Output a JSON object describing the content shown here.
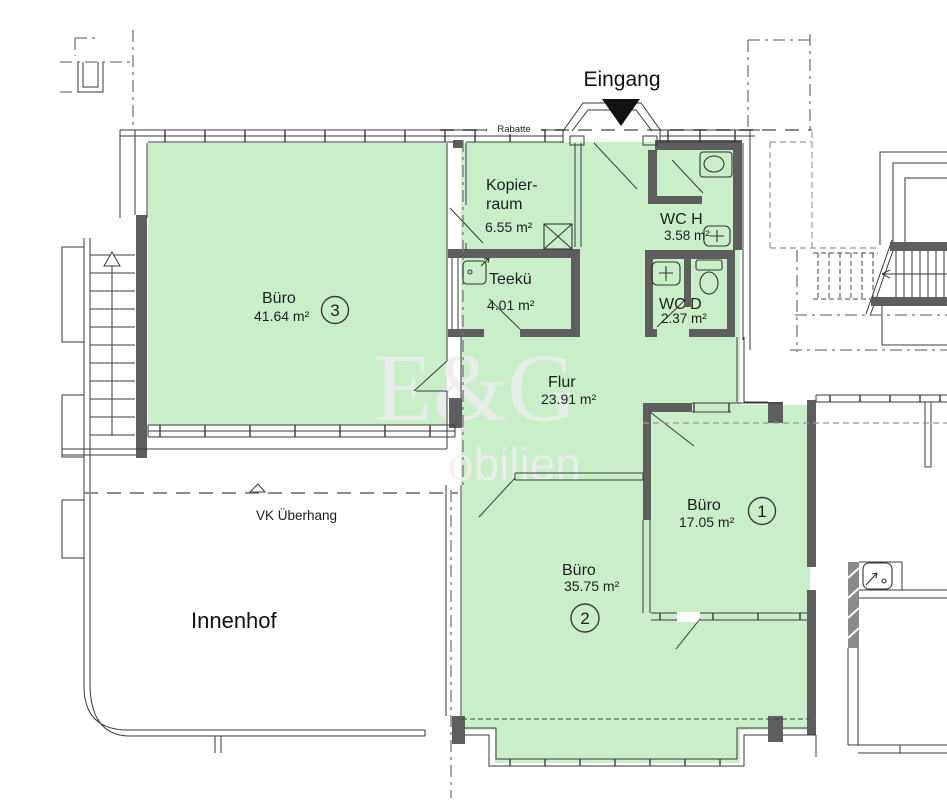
{
  "plan": {
    "type": "Grundriss Bürofläche",
    "colors": {
      "room_fill": "#c9efc9",
      "wall_dark": "#5e5e5e",
      "line": "#3a3a3a",
      "dash": "#8c8c8c",
      "watermark": "#ededed"
    },
    "labels": {
      "eingang": "Eingang",
      "rabatte": "Rabatte",
      "vk_ueberhang": "VK Überhang",
      "innenhof": "Innenhof"
    },
    "watermark": {
      "line1": "E&G",
      "line2": "obilien"
    },
    "rooms": [
      {
        "id": "buero-3",
        "label": "Büro",
        "area": "41.64 m²",
        "number": "3"
      },
      {
        "id": "kopierraum",
        "name_line1": "Kopier-",
        "name_line2": "raum",
        "area": "6.55 m²"
      },
      {
        "id": "wc-h",
        "label": "WC H",
        "area": "3.58 m²"
      },
      {
        "id": "wc-d",
        "label": "WC D",
        "area": "2.37 m²"
      },
      {
        "id": "teekueche",
        "label": "Teekü",
        "area": "4.01 m²"
      },
      {
        "id": "flur",
        "label": "Flur",
        "area": "23.91 m²"
      },
      {
        "id": "buero-1",
        "label": "Büro",
        "area": "17.05 m²",
        "number": "1"
      },
      {
        "id": "buero-2",
        "label": "Büro",
        "area": "35.75 m²",
        "number": "2"
      }
    ]
  }
}
